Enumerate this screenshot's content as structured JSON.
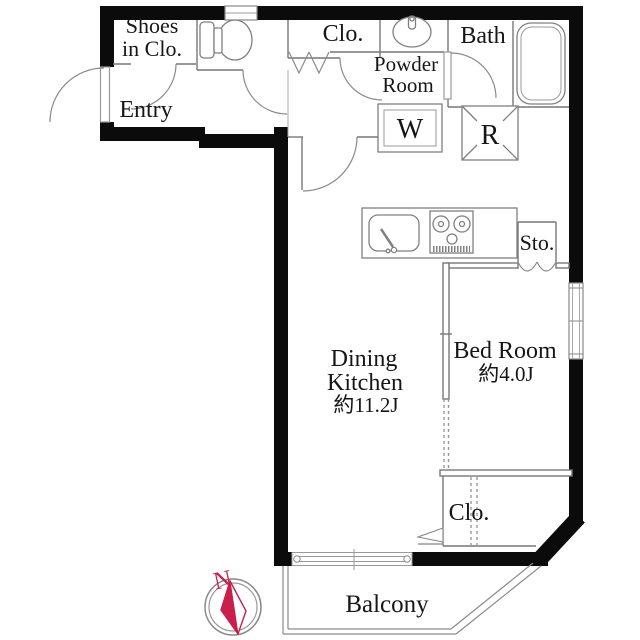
{
  "plan": {
    "rooms": {
      "shoes_closet": {
        "label_line1": "Shoes",
        "label_line2": "in Clo."
      },
      "entry": {
        "label": "Entry"
      },
      "closet_top": {
        "label": "Clo."
      },
      "powder_room": {
        "label_line1": "Powder",
        "label_line2": "Room"
      },
      "bath": {
        "label": "Bath"
      },
      "washer": {
        "label": "W"
      },
      "refrigerator": {
        "label": "R"
      },
      "storage": {
        "label": "Sto."
      },
      "dining_kitchen": {
        "label_line1": "Dining",
        "label_line2": "Kitchen",
        "area": "約11.2J"
      },
      "bed_room": {
        "label": "Bed Room",
        "area": "約4.0J"
      },
      "closet_bottom": {
        "label": "Clo."
      },
      "balcony": {
        "label": "Balcony"
      }
    },
    "compass": {
      "north_label": "N"
    },
    "colors": {
      "wall": "#0b0b0b",
      "thin_line": "#777777",
      "text": "#161616",
      "compass_red": "#c81f4b"
    }
  }
}
